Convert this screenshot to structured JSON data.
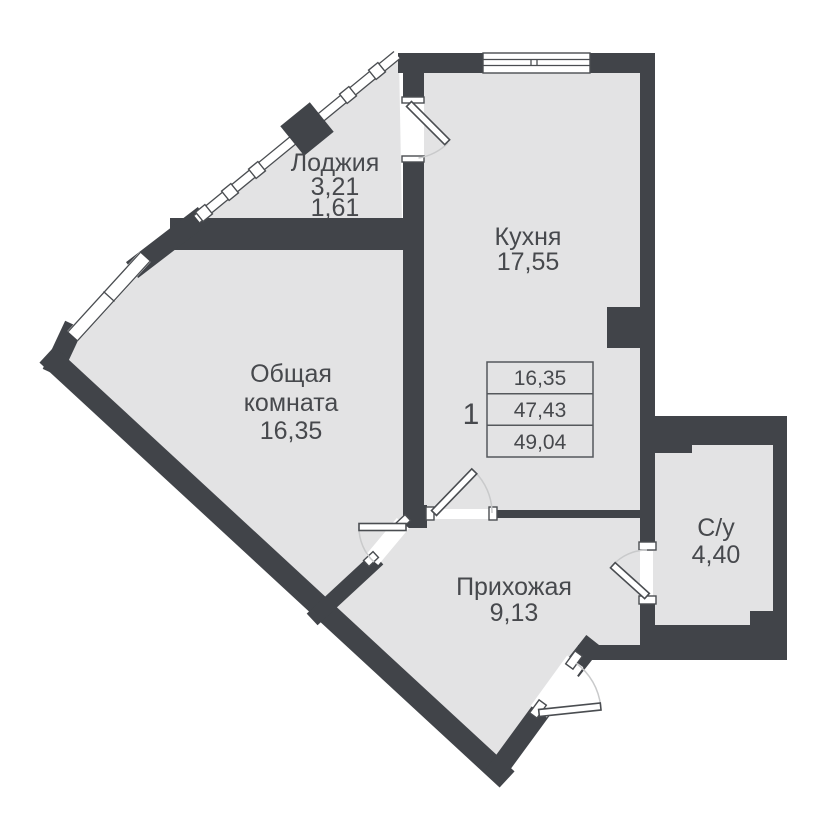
{
  "plan": {
    "rooms": {
      "loggia": {
        "name": "Лоджия",
        "area_full": "3,21",
        "area_counted": "1,61"
      },
      "kitchen": {
        "name": "Кухня",
        "area": "17,55"
      },
      "living": {
        "name_line1": "Общая",
        "name_line2": "комната",
        "area": "16,35"
      },
      "hallway": {
        "name": "Прихожая",
        "area": "9,13"
      },
      "bathroom": {
        "name": "С/у",
        "area": "4,40"
      }
    },
    "summary": {
      "apartment_number": "1",
      "living_area": "16,35",
      "area_without_loggia": "47,43",
      "total_area": "49,04"
    },
    "colors": {
      "wall": "#414449",
      "floor": "#e3e3e4",
      "text": "#47494d",
      "door_arc": "#c9cacb",
      "background": "#ffffff"
    }
  }
}
